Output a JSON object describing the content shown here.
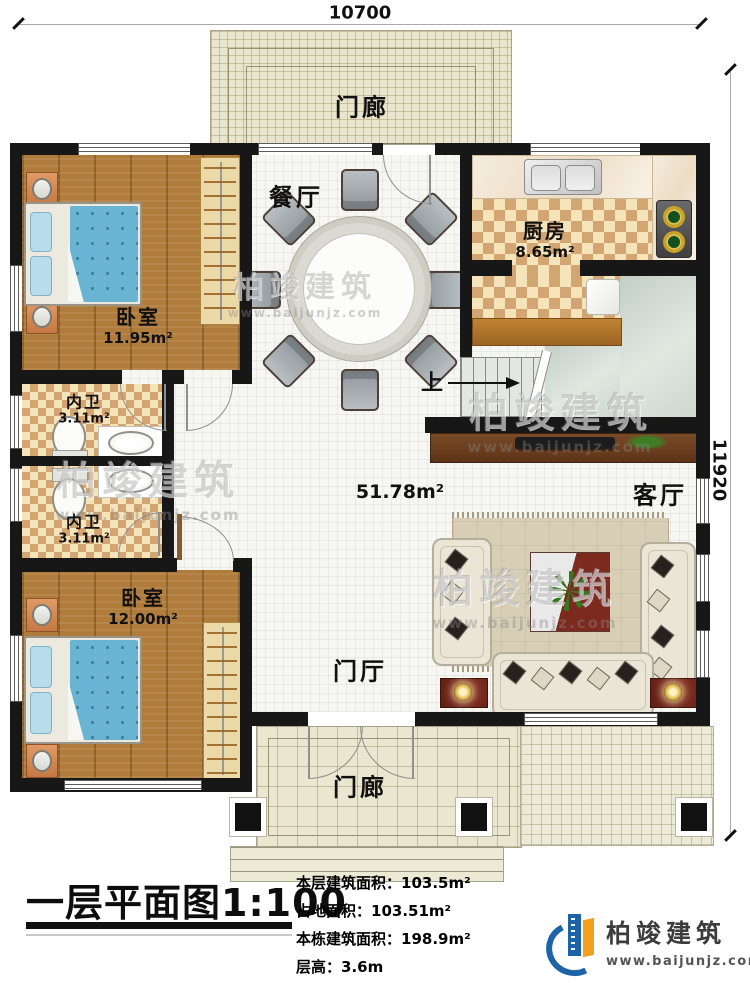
{
  "dimensions": {
    "top": "10700",
    "right": "11920"
  },
  "rooms": {
    "porch_top": {
      "label": "门廊"
    },
    "porch_bottom": {
      "label": "门廊"
    },
    "dining": {
      "label": "餐厅"
    },
    "kitchen": {
      "label": "厨房",
      "area": "8.65m²"
    },
    "bedroom_top": {
      "label": "卧室",
      "area": "11.95m²"
    },
    "bath_top": {
      "label": "内卫",
      "area": "3.11m²"
    },
    "bath_bottom": {
      "label": "内卫",
      "area": "3.11m²"
    },
    "bedroom_bottom": {
      "label": "卧室",
      "area": "12.00m²"
    },
    "living": {
      "label": "客厅"
    },
    "hall": {
      "label": "门厅"
    },
    "open_area": {
      "area": "51.78m²"
    },
    "stairs": {
      "direction": "上"
    }
  },
  "footer": {
    "title": "一层平面图",
    "scale": "1:100",
    "stats": [
      {
        "label": "本层建筑面积：",
        "value": "103.5m²"
      },
      {
        "label": "占地面积：",
        "value": "103.51m²"
      },
      {
        "label": "本栋建筑面积：",
        "value": "198.9m²"
      },
      {
        "label": "层高：",
        "value": "3.6m"
      }
    ],
    "logo": {
      "name": "柏竣建筑",
      "website": "www.baijunjz.com"
    }
  },
  "watermark": {
    "name": "柏竣建筑",
    "website": "www.baijunjz.com"
  },
  "colors": {
    "wall": "#171717",
    "brand_blue": "#1c63a8",
    "brand_orange": "#f2a01d",
    "wood_floor": "#b07c3c",
    "porch_tile": "#e9e5cd",
    "checker_dark": "#d2a572",
    "checker_light": "#f5e3b9",
    "landing_green": "#ccd6cd",
    "bed_blue": "#68b4d2",
    "accent_red": "#7c2a1e"
  }
}
